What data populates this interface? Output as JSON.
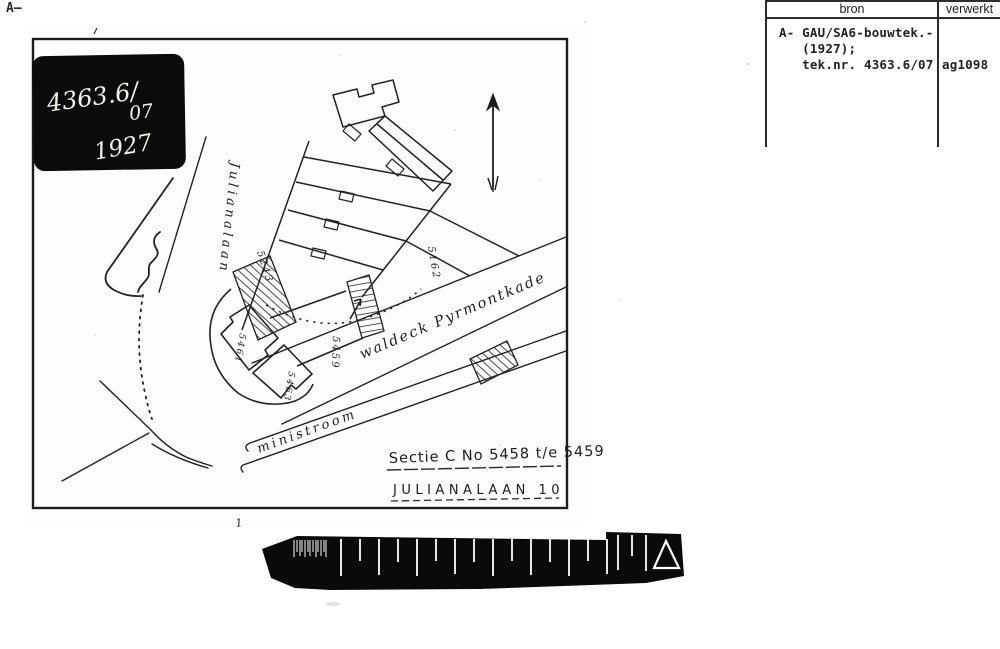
{
  "page": {
    "corner_label": "A—"
  },
  "archive_table": {
    "headers": {
      "bron": "bron",
      "verwerkt": "verwerkt"
    },
    "bron_entry_lines": "A- GAU/SA6-bouwtek.-\n   (1927);\n   tek.nr. 4363.6/07",
    "verwerkt_entry": "ag1098"
  },
  "stamp": {
    "number": "4363.6/",
    "suffix": "07",
    "year": "1927"
  },
  "map": {
    "street_labels": {
      "julianalaan": "Julianalaan",
      "kade": "waldeck Pyrmontkade",
      "stream": "ministroom"
    },
    "parcel_numbers": {
      "p5243": "5243",
      "p5162": "5162",
      "p5459": "5459",
      "p5461": "5461",
      "p5463": "5463"
    },
    "captions": {
      "sectie": "Sectie C No 5458 t/e 5459",
      "address": "JULIANALAAN 10"
    },
    "scale_bar_mark": "1"
  },
  "colors": {
    "ink": "#1e1e1e",
    "stamp_bg": "#0b0b0b",
    "bar_bg": "#0a0a0a",
    "paper": "#fdfdfb"
  }
}
